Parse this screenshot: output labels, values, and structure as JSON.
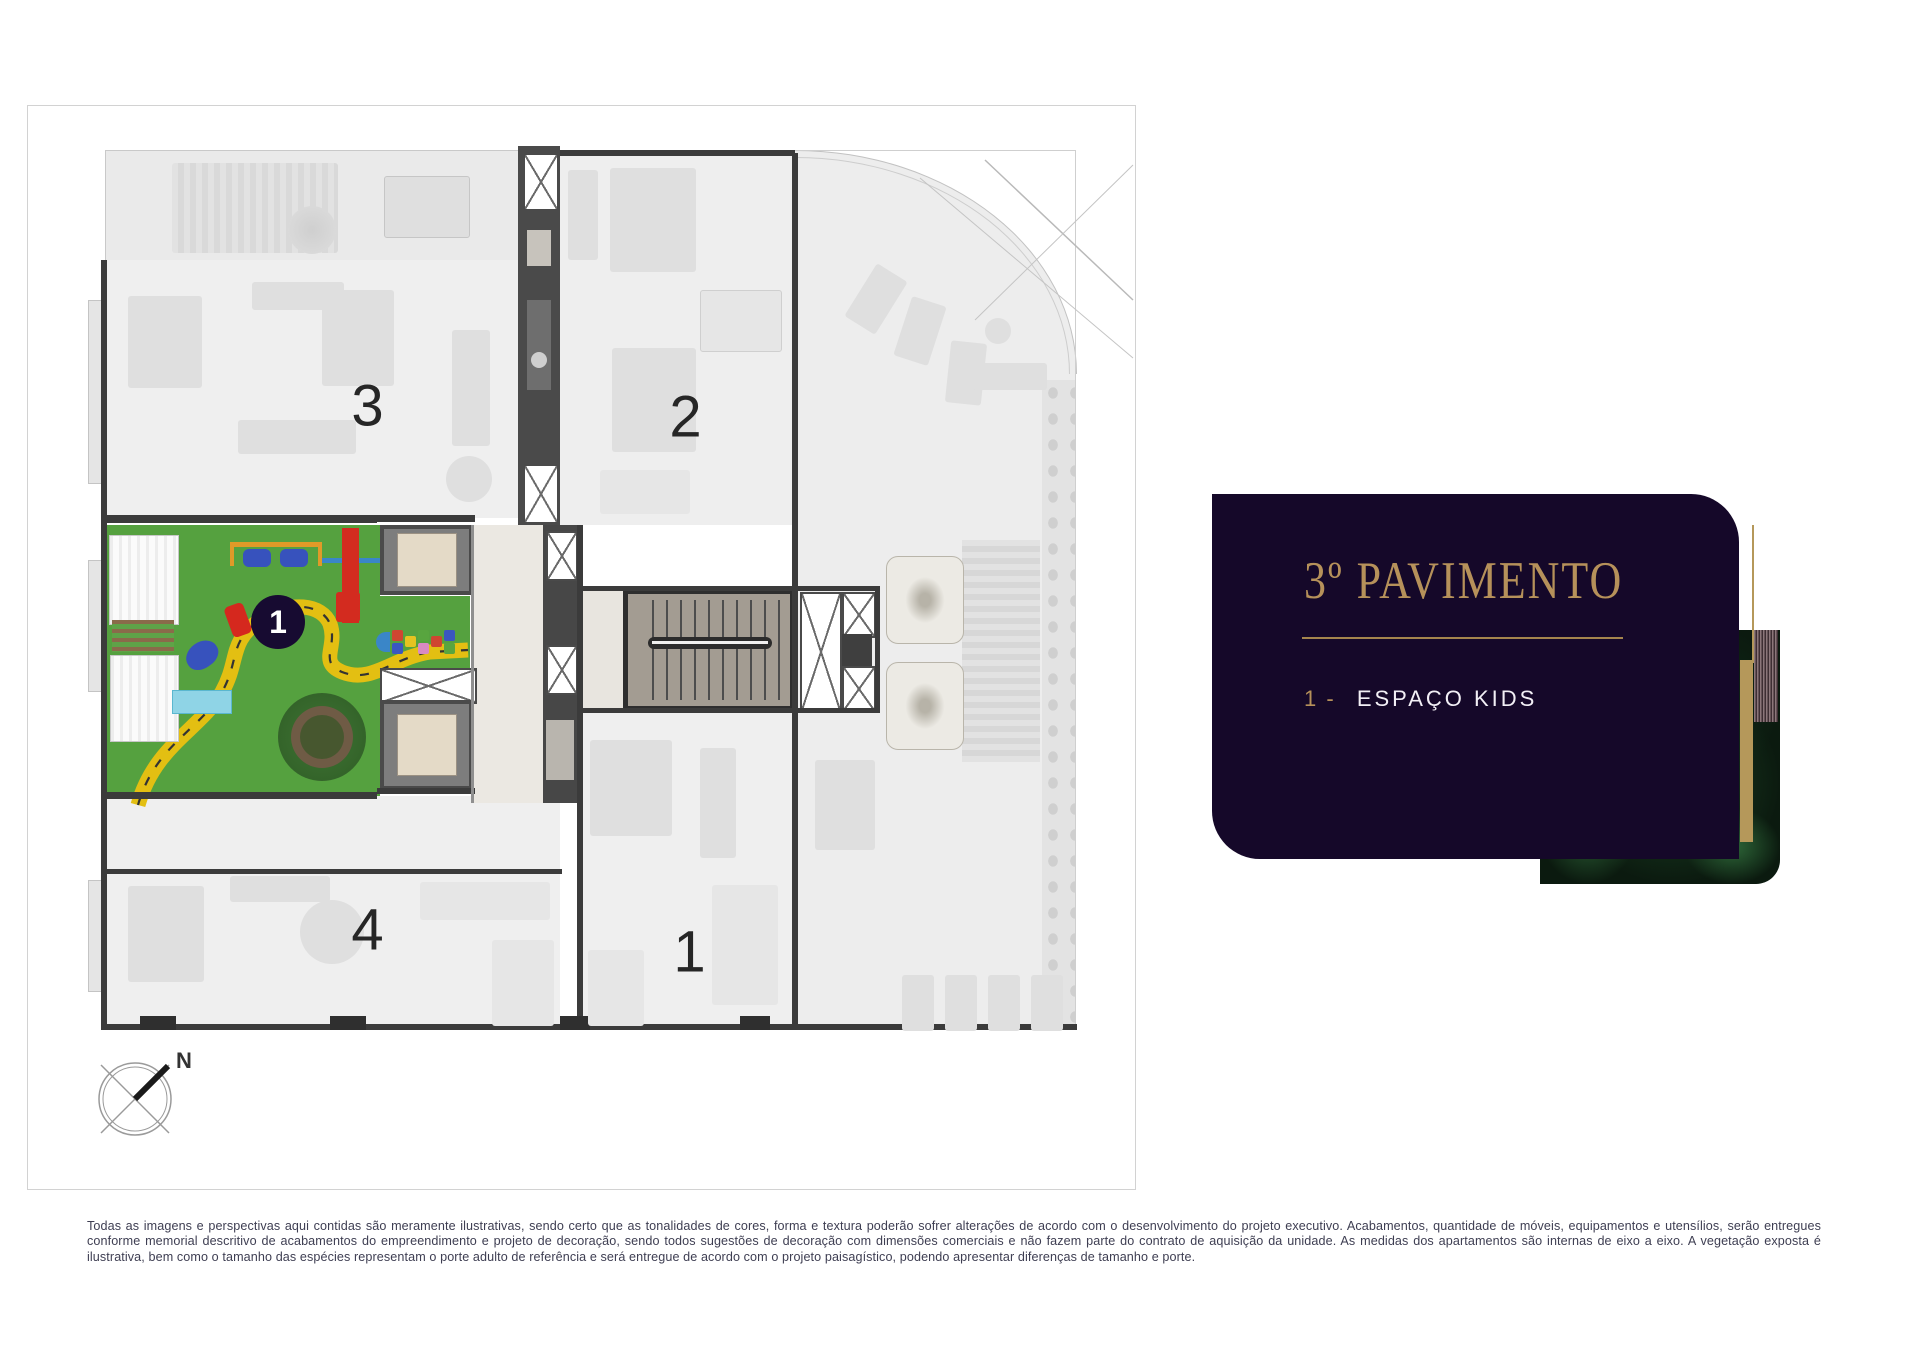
{
  "floor_plan": {
    "units": [
      {
        "label": "3"
      },
      {
        "label": "2"
      },
      {
        "label": "4"
      },
      {
        "label": "1"
      }
    ],
    "kids_marker_label": "1",
    "compass_label": "N"
  },
  "info_card": {
    "title": "3º PAVIMENTO",
    "legend": [
      {
        "prefix": "1 -",
        "label": "ESPAÇO KIDS"
      }
    ]
  },
  "disclaimer": "Todas as imagens e perspectivas aqui contidas são meramente ilustrativas, sendo certo que as tonalidades de cores, forma e textura poderão sofrer alterações de acordo com o desenvolvimento do projeto executivo. Acabamentos, quantidade de móveis, equipamentos e utensílios, serão entregues conforme memorial descritivo de acabamentos do empreendimento e projeto de decoração, sendo todos sugestões de decoração com dimensões comerciais e não fazem parte do contrato de aquisição da unidade. As medidas dos apartamentos são internas de eixo a eixo. A vegetação exposta é ilustrativa, bem como o tamanho das espécies representam o porte adulto de referência e será entregue de acordo com o projeto paisagístico, podendo apresentar diferenças de tamanho e porte.",
  "colors": {
    "card_background": "#150829",
    "gold": "#b6915a",
    "grass_green": "#55a13f",
    "path_yellow": "#e3bf12",
    "marker_navy": "#170b31",
    "wall_gray": "#3b3b3b",
    "legend_white": "#f2eff5",
    "disclaimer_gray": "#3e3e52"
  }
}
